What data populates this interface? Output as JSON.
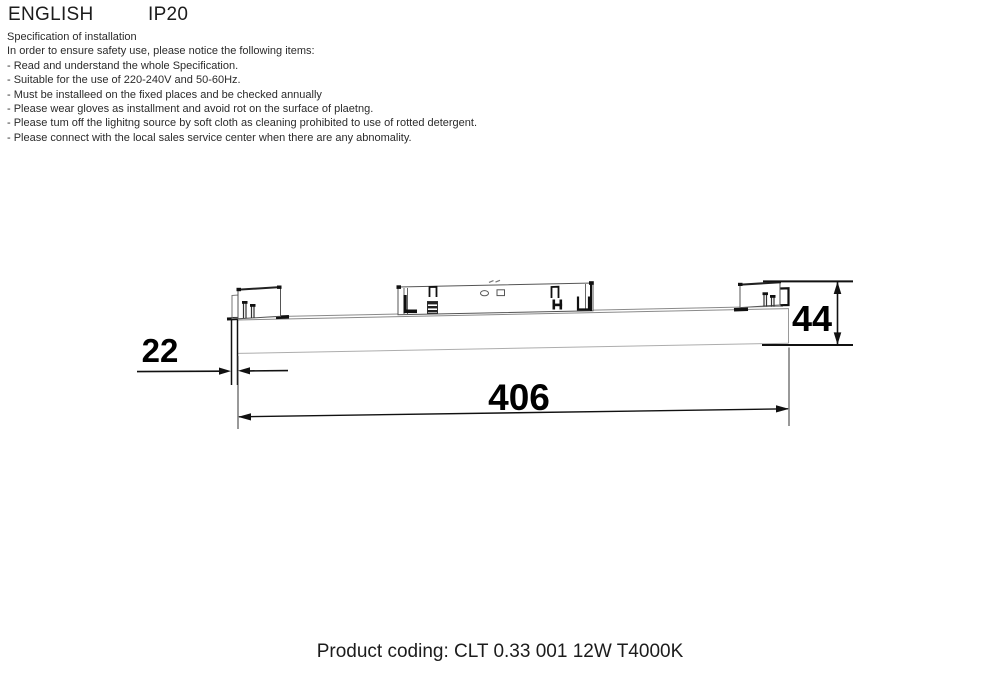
{
  "header": {
    "language": "ENGLISH",
    "ip_rating": "IP20"
  },
  "notice": {
    "title": "Specification of installation",
    "intro": "In order to ensure safety use, please notice the following items:",
    "items": [
      "- Read and understand the whole Specification.",
      "- Suitable for the use of 220-240V and 50-60Hz.",
      "- Must be installeed on the fixed places and be checked annually",
      "- Please wear gloves as installment and avoid rot on the surface of plaetng.",
      "- Please tum off the lighitng source by soft cloth as cleaning prohibited to use of rotted detergent.",
      "- Please connect with the local sales service center when there are any abnomality."
    ]
  },
  "drawing": {
    "description": "side view of linear track light fixture with mounting brackets",
    "dim_length": "406",
    "dim_height": "44",
    "dim_offset": "22",
    "line_color_dark": "#111111",
    "line_color_light": "#9a9a9a"
  },
  "footer": {
    "product_coding": "Product coding: CLT 0.33 001 12W T4000K"
  }
}
